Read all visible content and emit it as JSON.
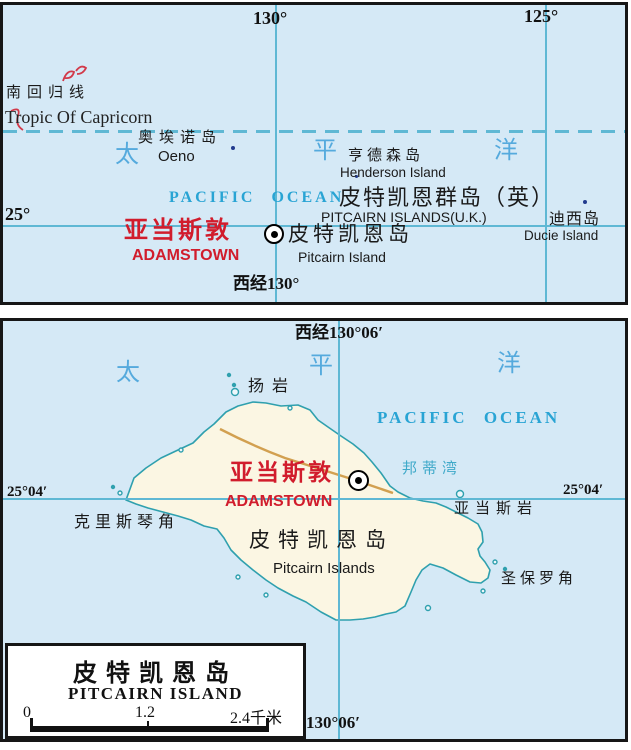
{
  "panel1": {
    "lon_labels": [
      "130°",
      "125°"
    ],
    "lat_label": "25°",
    "bottom_lon_label": "西经130°",
    "tropic_zh": "南回归线",
    "tropic_en": "Tropic Of Capricorn",
    "ocean_zh": [
      "太",
      "平",
      "洋"
    ],
    "ocean_en": "PACIFIC OCEAN",
    "oeno_zh": "奥埃诺岛",
    "oeno_en": "Oeno",
    "henderson_zh": "亨德森岛",
    "henderson_en": "Henderson Island",
    "group_zh": "皮特凯恩群岛（英）",
    "group_en": "PITCAIRN ISLANDS(U.K.)",
    "ducie_zh": "迪西岛",
    "ducie_en": "Ducie Island",
    "capital_zh": "亚当斯敦",
    "capital_en": "ADAMSTOWN",
    "pitcairn_zh": "皮特凯恩岛",
    "pitcairn_en": "Pitcairn Island"
  },
  "panel2": {
    "top_lon_label": "西经130°06′",
    "bottom_lon_label": "130°06′",
    "lat_label_left": "25°04′",
    "lat_label_right": "25°04′",
    "ocean_zh": [
      "太",
      "平",
      "洋"
    ],
    "ocean_en": "PACIFIC OCEAN",
    "young_rock": "扬岩",
    "bounty_bay": "邦蒂湾",
    "capital_zh": "亚当斯敦",
    "capital_en": "ADAMSTOWN",
    "christian_point": "克里斯琴角",
    "adams_rock": "亚当斯岩",
    "island_zh": "皮特凯恩岛",
    "island_en": "Pitcairn Islands",
    "st_pauls_point": "圣保罗角",
    "legend": {
      "title_zh": "皮特凯恩岛",
      "title_en": "PITCAIRN ISLAND",
      "scale": [
        "0",
        "1.2",
        "2.4千米"
      ]
    }
  },
  "colors": {
    "sea": "#d5e9f6",
    "land": "#fbf6e3",
    "coastline": "#2fa0ae",
    "road": "#d2a050",
    "grid_line": "#5fb8d4",
    "capital_text": "#d11c2c",
    "ocean_text": "#29a4d4",
    "island_dot": "#223b8e"
  }
}
